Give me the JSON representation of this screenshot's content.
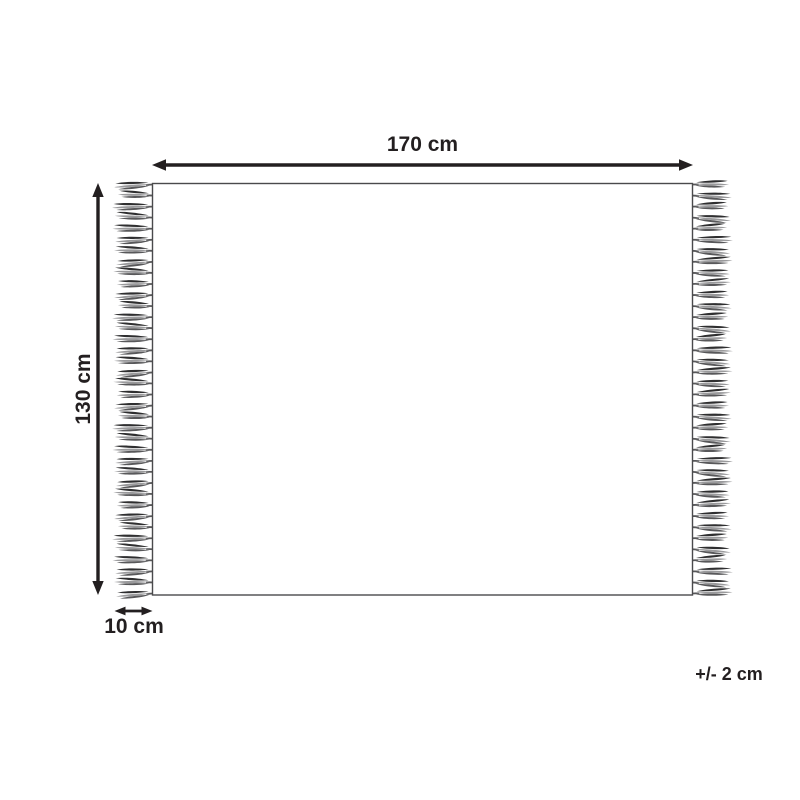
{
  "diagram": {
    "labels": {
      "width": "170 cm",
      "height": "130 cm",
      "fringe": "10 cm",
      "tolerance": "+/- 2 cm"
    },
    "colors": {
      "line": "#231f20",
      "outline": "#4a4a4c",
      "tassel_dark": "#2f2f30",
      "tassel_mid": "#58585a",
      "tassel_light": "#9a9a9c",
      "background": "#ffffff"
    },
    "fringe": {
      "sides": [
        "left",
        "right"
      ],
      "tassels_per_side": 38
    }
  }
}
